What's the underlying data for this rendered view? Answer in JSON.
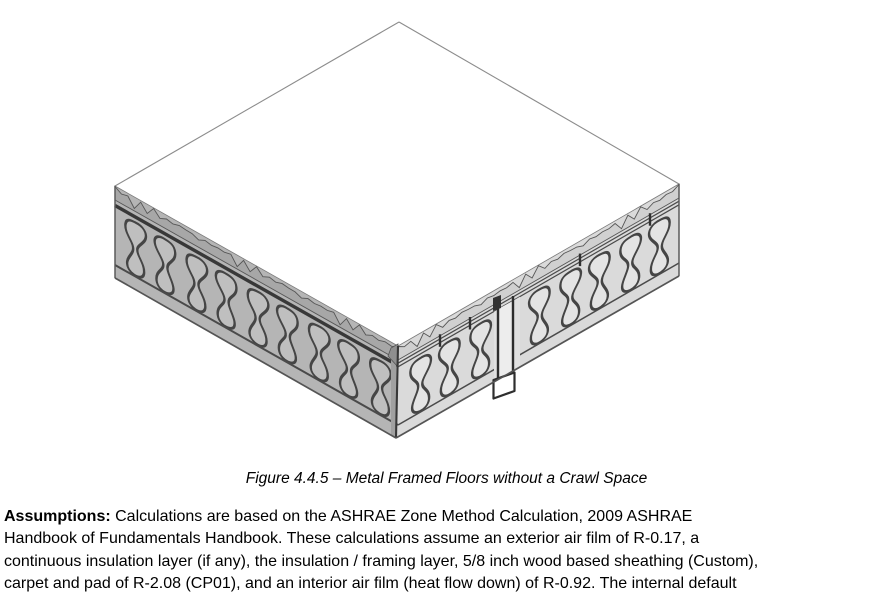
{
  "page": {
    "background": "#ffffff"
  },
  "figure": {
    "caption": "Figure 4.4.5 – Metal Framed Floors without a Crawl Space",
    "illustration": "isometric cutaway of a metal framed floor assembly: white sheathing deck on top with torn jagged edges, insulation batts between metal framing on both exposed side faces, and an exposed metal C-stud hanging at the front right face",
    "colors": {
      "top_face": "#ffffff",
      "left_face": "#b5b5b5",
      "left_band": "#a7a7a7",
      "left_batt_fill": "#bfbfbf",
      "right_face": "#dadada",
      "right_band": "#d0d0d0",
      "right_batt_fill": "#e4e4e4",
      "batt_outline": "#454545",
      "outline_dark": "#383838",
      "outline_mid": "#5a5a5a",
      "edge_light": "#8c8c8c",
      "stud_outline": "#2e2e2e",
      "corner_wedge": "#8f8f8f"
    }
  },
  "assumptions": {
    "label": "Assumptions:",
    "line1": "Calculations are based on the ASHRAE Zone Method Calculation, 2009 ASHRAE",
    "line2": "Handbook of Fundamentals Handbook. These calculations assume an exterior air film of R-0.17, a",
    "line3": "continuous insulation layer (if any), the insulation / framing layer, 5/8 inch wood based sheathing (Custom),",
    "line4": "carpet and pad of R-2.08 (CP01), and an interior air film (heat flow down) of R-0.92. The internal default"
  }
}
